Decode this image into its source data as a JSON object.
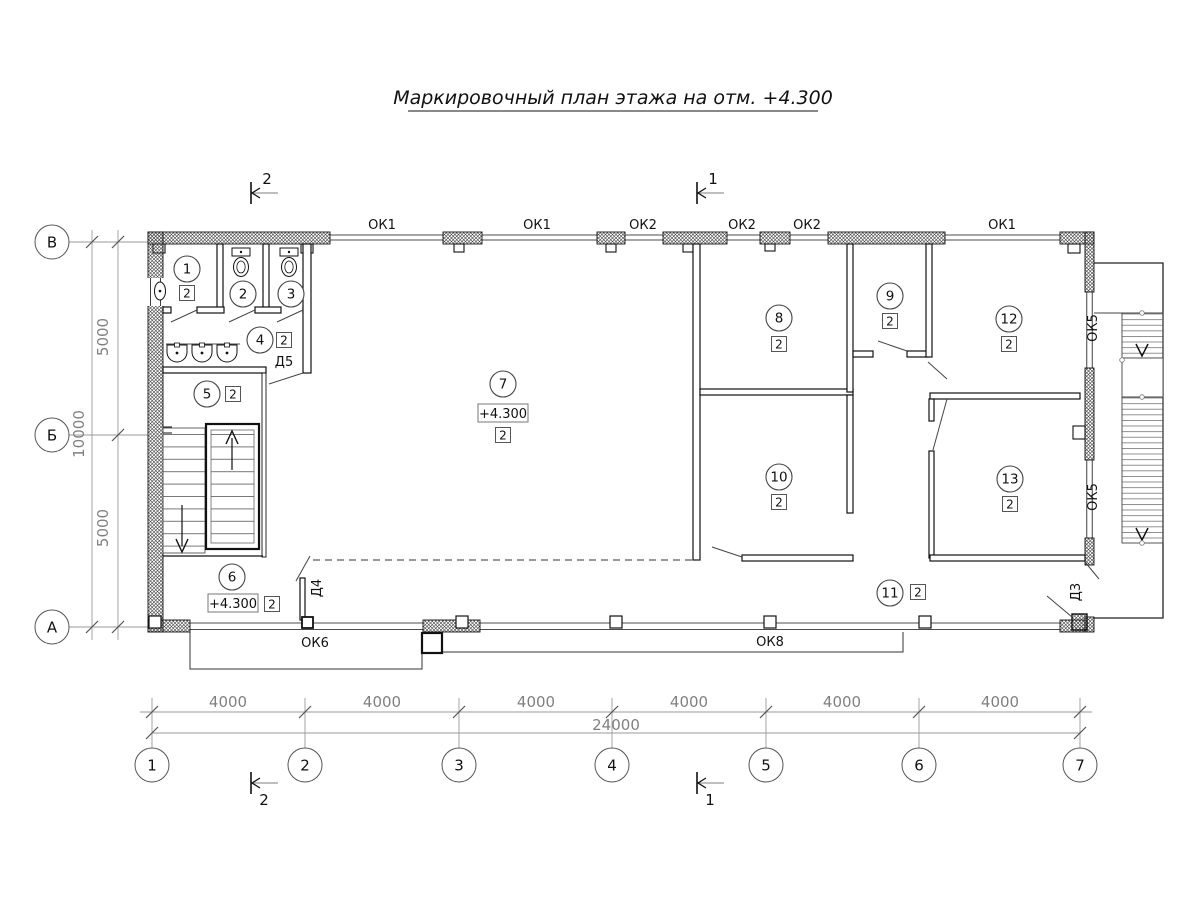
{
  "title": "Маркировочный план этажа на отм. +4.300",
  "grid": {
    "h": [
      "1",
      "2",
      "3",
      "4",
      "5",
      "6",
      "7"
    ],
    "v": [
      "В",
      "Б",
      "А"
    ]
  },
  "dims": {
    "bay": "4000",
    "total_width": "24000",
    "half_depth": "5000",
    "total_depth": "10000"
  },
  "sections": {
    "one": "1",
    "two": "2"
  },
  "rooms": [
    {
      "num": "1",
      "mark": "2"
    },
    {
      "num": "2"
    },
    {
      "num": "3"
    },
    {
      "num": "4",
      "mark": "2"
    },
    {
      "num": "5",
      "mark": "2"
    },
    {
      "num": "6",
      "mark": "2",
      "elevation": "+4.300"
    },
    {
      "num": "7",
      "mark": "2",
      "elevation": "+4.300"
    },
    {
      "num": "8",
      "mark": "2"
    },
    {
      "num": "9",
      "mark": "2"
    },
    {
      "num": "10",
      "mark": "2"
    },
    {
      "num": "11",
      "mark": "2"
    },
    {
      "num": "12",
      "mark": "2"
    },
    {
      "num": "13",
      "mark": "2"
    }
  ],
  "windows": {
    "ok1": "ОК1",
    "ok2": "ОК2",
    "ok5": "ОК5",
    "ok6": "ОК6",
    "ok8": "ОК8"
  },
  "doors": {
    "d3": "Д3",
    "d4": "Д4",
    "d5": "Д5"
  }
}
